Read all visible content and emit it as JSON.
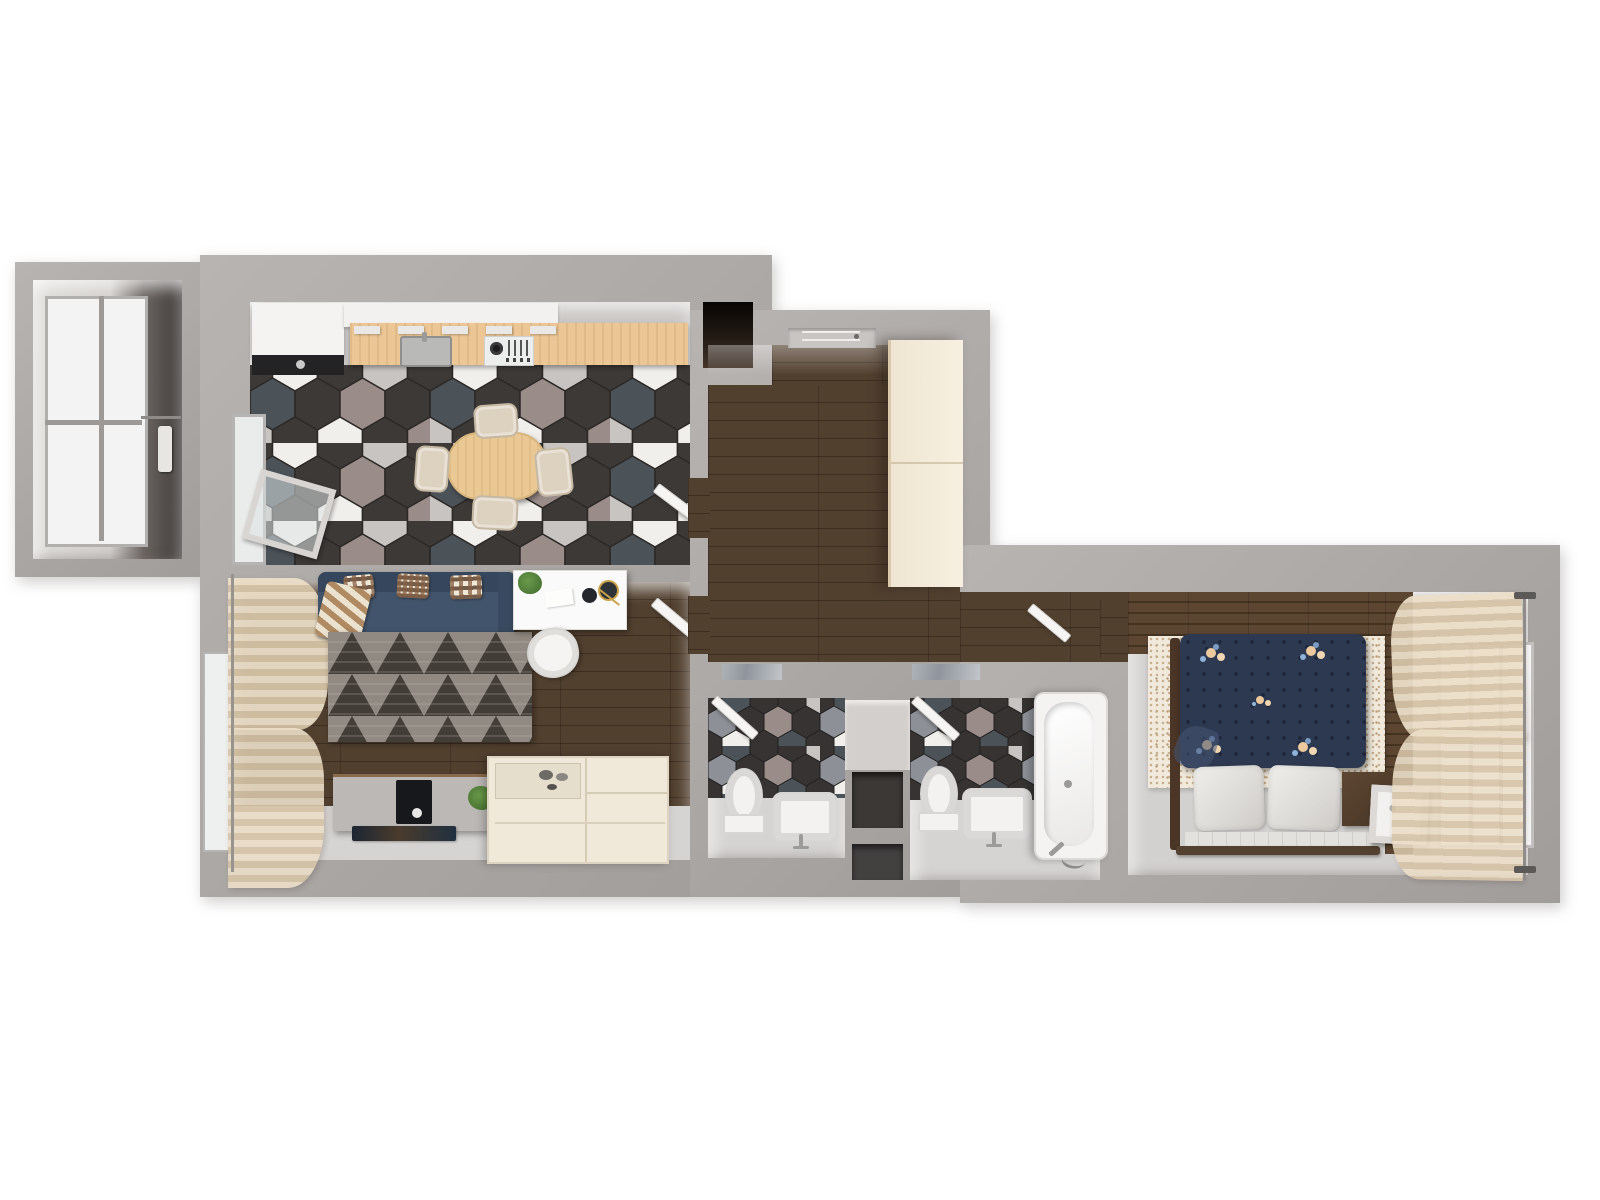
{
  "meta": {
    "title": "Top-down 3D render floor plan of a one-bedroom apartment",
    "view": "overhead axonometric render",
    "text_on_image": "none"
  },
  "palette": {
    "background": "#ffffff",
    "wall": "#aba7a5",
    "wall_inner_face": "#d6d3d1",
    "dark_wood_floor": "#47362a",
    "kitchen_counter_wood": "#ecc795",
    "hex_tile_charcoal": "#3d3937",
    "hex_tile_white": "#f1efec",
    "hex_tile_gray": "#c7c4c1",
    "hex_tile_mauve": "#9a8c89",
    "hex_tile_marble": "#4b5258",
    "sofa_navy": "#42546b",
    "duvet_navy": "#2d3950",
    "cream_furniture": "#f0e9da",
    "light_floor": "#d6d4d2",
    "curtain_beige": "#e4d5ba",
    "rug_gray": "#8f8780",
    "plant_green": "#4f7a38"
  },
  "rooms": {
    "balcony": {
      "label": "Balcony",
      "features": [
        "full-height glazing",
        "drying rail with hanging cloth"
      ]
    },
    "kitchen": {
      "label": "Kitchen-dining room",
      "features": [
        "tall white cabinet",
        "white upper cabinets",
        "wood countertop",
        "sink",
        "gas hob",
        "oval wood dining table",
        "4 upholstered chairs",
        "hexagon tile floor",
        "window to balcony",
        "tilted open balcony sash",
        "open door to hallway"
      ]
    },
    "living": {
      "label": "Living room",
      "features": [
        "navy sofa",
        "3 checkered pillows",
        "plaid throw",
        "triangle-pattern rug",
        "white desk with plant and decor",
        "white shell desk chair",
        "gray TV stand with TV",
        "floor plant",
        "cream storage sideboard",
        "sheer curtain over window",
        "open door to hallway"
      ]
    },
    "closet": {
      "label": "Built-in closet",
      "features": [
        "dark storage niche"
      ]
    },
    "hallway": {
      "label": "Entrance hall",
      "features": [
        "entry door",
        "cream wardrobe",
        "dark plank flooring",
        "marble thresholds"
      ]
    },
    "wc": {
      "label": "WC",
      "features": [
        "toilet",
        "washbasin with faucet",
        "dark hexagon tile wall",
        "open door"
      ]
    },
    "shaft": {
      "label": "Service shaft",
      "features": [
        "two dark niches"
      ]
    },
    "bathroom": {
      "label": "Bathroom",
      "features": [
        "toilet",
        "washbasin with faucet",
        "bathtub with drain and shower mixer",
        "dark hexagon tile wall",
        "open door"
      ]
    },
    "corridor": {
      "label": "Corridor to bedroom",
      "features": [
        "dark plank flooring",
        "open bedroom door"
      ]
    },
    "bedroom": {
      "label": "Bedroom",
      "features": [
        "double bed with navy floral duvet",
        "two white pillows",
        "tufted bench edge",
        "wood bed frame",
        "speckled cream rug",
        "dark wood accent wall",
        "nightstand",
        "white cube bedside lamp",
        "sheer curtains",
        "window wall",
        "curtain rod"
      ]
    }
  }
}
